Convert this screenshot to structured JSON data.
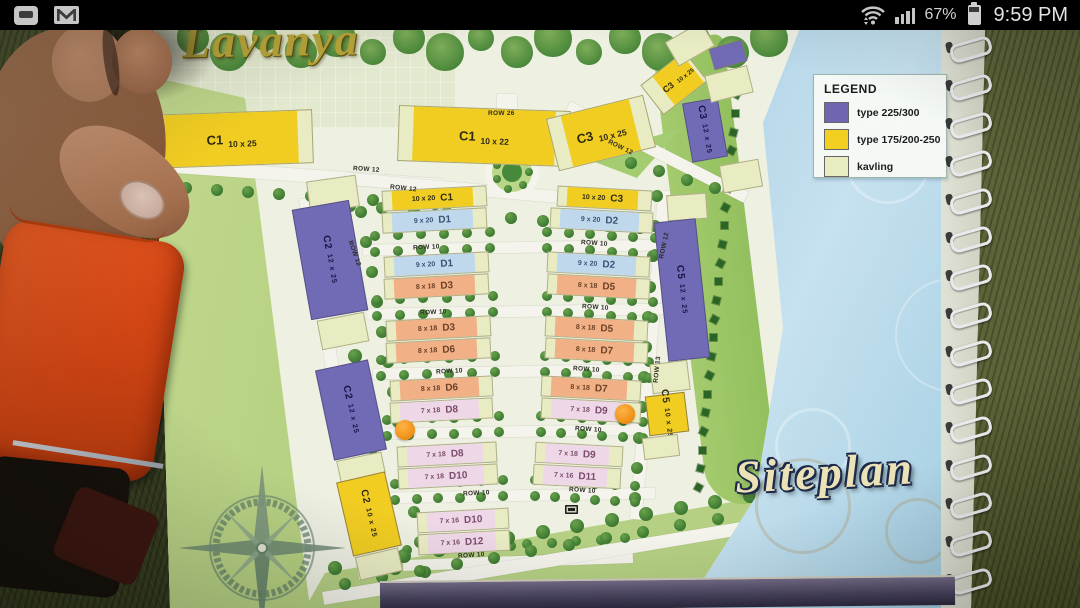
{
  "status_bar": {
    "time": "9:59 PM",
    "battery_percent": "67%",
    "left_icons": [
      "bbm-icon",
      "gmail-icon"
    ],
    "right_icons": [
      "wifi-icon",
      "signal-strength-icon",
      "battery-icon"
    ]
  },
  "siteplan": {
    "brand": "Lavanya",
    "caption": "Siteplan",
    "legend": {
      "heading": "LEGEND",
      "items": [
        {
          "label": "type 225/300",
          "color": "#6f66b2"
        },
        {
          "label": "type 175/200-250",
          "color": "#f2d021"
        },
        {
          "label": "kavling",
          "color": "#e9ecc3"
        }
      ]
    },
    "type_colors": {
      "purple": "#716ab5",
      "yellow": "#f1cd22",
      "kavling": "#e9ecc3",
      "blue": "#c0d8eb",
      "orange": "#f1b086",
      "pink": "#eed8e8"
    },
    "text_colors": {
      "purple": "#191447",
      "yellow": "#2e2a12",
      "kavling": "#77774f",
      "blue": "#3c5276",
      "orange": "#6d4227",
      "pink": "#7c4b6b"
    },
    "blocks": [
      {
        "c": "C1",
        "s": "10 x 25",
        "t": "yellow",
        "o": "strip",
        "x": 55,
        "y": 84,
        "w": 163,
        "h": 54,
        "r": -2
      },
      {
        "c": "C1",
        "s": "10 x 22",
        "t": "yellow",
        "o": "strip",
        "x": 303,
        "y": 80,
        "w": 172,
        "h": 56,
        "r": 2
      },
      {
        "c": "C3",
        "s": "10 x 25",
        "t": "yellow",
        "o": "strip",
        "x": 456,
        "y": 78,
        "w": 100,
        "h": 54,
        "r": -14
      },
      {
        "c": "C3",
        "s": "10 x 25",
        "t": "yellow",
        "o": "strip-sm",
        "x": 551,
        "y": 36,
        "w": 56,
        "h": 38,
        "r": -38
      },
      {
        "c": "C3",
        "s": "12 x 25",
        "t": "purple",
        "o": "v",
        "x": 592,
        "y": 72,
        "w": 36,
        "h": 60,
        "r": -10
      },
      {
        "c": "",
        "s": "",
        "t": "purple",
        "o": "kav",
        "x": 616,
        "y": 16,
        "w": 34,
        "h": 22,
        "r": -16
      },
      {
        "c": "",
        "s": "",
        "t": "kavling",
        "o": "kav",
        "x": 574,
        "y": 2,
        "w": 42,
        "h": 28,
        "r": -30
      },
      {
        "c": "",
        "s": "",
        "t": "kavling",
        "o": "kav",
        "x": 612,
        "y": 42,
        "w": 44,
        "h": 28,
        "r": -14
      },
      {
        "c": "",
        "s": "",
        "t": "kavling",
        "o": "kav",
        "x": 626,
        "y": 134,
        "w": 40,
        "h": 28,
        "r": -10
      },
      {
        "c": "",
        "s": "",
        "t": "kavling",
        "o": "kav",
        "x": 213,
        "y": 150,
        "w": 50,
        "h": 32,
        "r": -8
      },
      {
        "c": "C2",
        "s": "12 x 25",
        "t": "purple",
        "o": "v",
        "x": 206,
        "y": 176,
        "w": 58,
        "h": 112,
        "r": -10
      },
      {
        "c": "",
        "s": "",
        "t": "kavling",
        "o": "kav",
        "x": 224,
        "y": 288,
        "w": 48,
        "h": 30,
        "r": -11
      },
      {
        "c": "C2",
        "s": "12 x 25",
        "t": "purple",
        "o": "v",
        "x": 229,
        "y": 336,
        "w": 54,
        "h": 92,
        "r": -12
      },
      {
        "c": "",
        "s": "",
        "t": "kavling",
        "o": "kav",
        "x": 243,
        "y": 428,
        "w": 46,
        "h": 22,
        "r": -12
      },
      {
        "c": "C2",
        "s": "10 x 25",
        "t": "yellow",
        "o": "v",
        "x": 249,
        "y": 448,
        "w": 50,
        "h": 76,
        "r": -13
      },
      {
        "c": "",
        "s": "",
        "t": "kavling",
        "o": "kav",
        "x": 262,
        "y": 524,
        "w": 44,
        "h": 24,
        "r": -13
      },
      {
        "c": "",
        "s": "",
        "t": "kavling",
        "o": "kav",
        "x": 572,
        "y": 166,
        "w": 40,
        "h": 26,
        "r": -4
      },
      {
        "c": "C5",
        "s": "12 x 25",
        "t": "purple",
        "o": "v",
        "x": 566,
        "y": 192,
        "w": 42,
        "h": 140,
        "r": -6
      },
      {
        "c": "",
        "s": "",
        "t": "kavling",
        "o": "kav",
        "x": 556,
        "y": 334,
        "w": 38,
        "h": 30,
        "r": -7
      },
      {
        "c": "C5",
        "s": "10 x 25",
        "t": "yellow",
        "o": "v",
        "x": 552,
        "y": 366,
        "w": 40,
        "h": 40,
        "r": -7
      },
      {
        "c": "",
        "s": "",
        "t": "kavling",
        "o": "kav",
        "x": 548,
        "y": 408,
        "w": 36,
        "h": 22,
        "r": -7
      },
      {
        "c": "C1",
        "s": "10 x 20",
        "t": "yellow",
        "o": "band",
        "x": 287,
        "y": 160,
        "w": 105,
        "h": 21,
        "r": -3
      },
      {
        "c": "D1",
        "s": "9 x 20",
        "t": "blue",
        "o": "band",
        "x": 287,
        "y": 182,
        "w": 105,
        "h": 21,
        "r": -3
      },
      {
        "c": "D1",
        "s": "9 x 20",
        "t": "blue",
        "o": "band",
        "x": 289,
        "y": 226,
        "w": 105,
        "h": 21,
        "r": -3
      },
      {
        "c": "D3",
        "s": "8 x 18",
        "t": "orange",
        "o": "band",
        "x": 289,
        "y": 248,
        "w": 105,
        "h": 21,
        "r": -3
      },
      {
        "c": "D3",
        "s": "8 x 18",
        "t": "orange",
        "o": "band",
        "x": 291,
        "y": 290,
        "w": 105,
        "h": 21,
        "r": -3
      },
      {
        "c": "D6",
        "s": "8 x 18",
        "t": "orange",
        "o": "band",
        "x": 291,
        "y": 312,
        "w": 105,
        "h": 21,
        "r": -3
      },
      {
        "c": "D6",
        "s": "8 x 18",
        "t": "orange",
        "o": "band",
        "x": 295,
        "y": 350,
        "w": 103,
        "h": 21,
        "r": -3
      },
      {
        "c": "D8",
        "s": "7 x 18",
        "t": "pink",
        "o": "band",
        "x": 295,
        "y": 372,
        "w": 103,
        "h": 21,
        "r": -3
      },
      {
        "c": "D8",
        "s": "7 x 18",
        "t": "pink",
        "o": "band",
        "x": 302,
        "y": 416,
        "w": 100,
        "h": 21,
        "r": -3
      },
      {
        "c": "D10",
        "s": "7 x 18",
        "t": "pink",
        "o": "band",
        "x": 303,
        "y": 438,
        "w": 100,
        "h": 21,
        "r": -3
      },
      {
        "c": "D10",
        "s": "7 x 16",
        "t": "pink",
        "o": "band",
        "x": 322,
        "y": 482,
        "w": 92,
        "h": 21,
        "r": -3
      },
      {
        "c": "D12",
        "s": "7 x 16",
        "t": "pink",
        "o": "band",
        "x": 323,
        "y": 504,
        "w": 92,
        "h": 21,
        "r": -3
      },
      {
        "c": "C3",
        "s": "10 x 20",
        "t": "yellow",
        "o": "band",
        "x": 462,
        "y": 160,
        "w": 95,
        "h": 21,
        "r": 3
      },
      {
        "c": "D2",
        "s": "9 x 20",
        "t": "blue",
        "o": "band",
        "x": 455,
        "y": 182,
        "w": 103,
        "h": 21,
        "r": 3
      },
      {
        "c": "D2",
        "s": "9 x 20",
        "t": "blue",
        "o": "band",
        "x": 452,
        "y": 226,
        "w": 103,
        "h": 21,
        "r": 3
      },
      {
        "c": "D5",
        "s": "8 x 18",
        "t": "orange",
        "o": "band",
        "x": 452,
        "y": 248,
        "w": 103,
        "h": 21,
        "r": 3
      },
      {
        "c": "D5",
        "s": "8 x 18",
        "t": "orange",
        "o": "band",
        "x": 450,
        "y": 290,
        "w": 103,
        "h": 21,
        "r": 3
      },
      {
        "c": "D7",
        "s": "8 x 18",
        "t": "orange",
        "o": "band",
        "x": 450,
        "y": 312,
        "w": 103,
        "h": 21,
        "r": 3
      },
      {
        "c": "D7",
        "s": "8 x 18",
        "t": "orange",
        "o": "band",
        "x": 446,
        "y": 350,
        "w": 100,
        "h": 21,
        "r": 3
      },
      {
        "c": "D9",
        "s": "7 x 18",
        "t": "pink",
        "o": "band",
        "x": 446,
        "y": 372,
        "w": 100,
        "h": 21,
        "r": 3
      },
      {
        "c": "D9",
        "s": "7 x 18",
        "t": "pink",
        "o": "band",
        "x": 440,
        "y": 416,
        "w": 88,
        "h": 21,
        "r": 3
      },
      {
        "c": "D11",
        "s": "7 x 16",
        "t": "pink",
        "o": "band",
        "x": 438,
        "y": 438,
        "w": 88,
        "h": 21,
        "r": 3
      }
    ],
    "row_labels": [
      {
        "t": "ROW 26",
        "x": 393,
        "y": 82,
        "r": 0
      },
      {
        "t": "ROW 12",
        "x": 258,
        "y": 138,
        "r": 4
      },
      {
        "t": "ROW 12",
        "x": 295,
        "y": 157,
        "r": 6
      },
      {
        "t": "ROW 12",
        "x": 512,
        "y": 116,
        "r": 26
      },
      {
        "t": "ROW 12",
        "x": 246,
        "y": 222,
        "r": 70
      },
      {
        "t": "ROW 12",
        "x": 556,
        "y": 214,
        "r": -78
      },
      {
        "t": "ROW 13",
        "x": 549,
        "y": 338,
        "r": -84
      },
      {
        "t": "ROW 10",
        "x": 318,
        "y": 216,
        "r": -3
      },
      {
        "t": "ROW 10",
        "x": 486,
        "y": 212,
        "r": 4
      },
      {
        "t": "ROW 10",
        "x": 325,
        "y": 281,
        "r": -3
      },
      {
        "t": "ROW 10",
        "x": 487,
        "y": 276,
        "r": 4
      },
      {
        "t": "ROW 10",
        "x": 341,
        "y": 340,
        "r": -3
      },
      {
        "t": "ROW 10",
        "x": 478,
        "y": 338,
        "r": 4
      },
      {
        "t": "ROW 10",
        "x": 480,
        "y": 398,
        "r": 4
      },
      {
        "t": "ROW 10",
        "x": 368,
        "y": 462,
        "r": -3
      },
      {
        "t": "ROW 10",
        "x": 474,
        "y": 459,
        "r": 4
      },
      {
        "t": "ROW 10",
        "x": 363,
        "y": 524,
        "r": -4
      }
    ],
    "markers": [
      {
        "x": 310,
        "y": 402
      },
      {
        "x": 530,
        "y": 386
      }
    ]
  }
}
